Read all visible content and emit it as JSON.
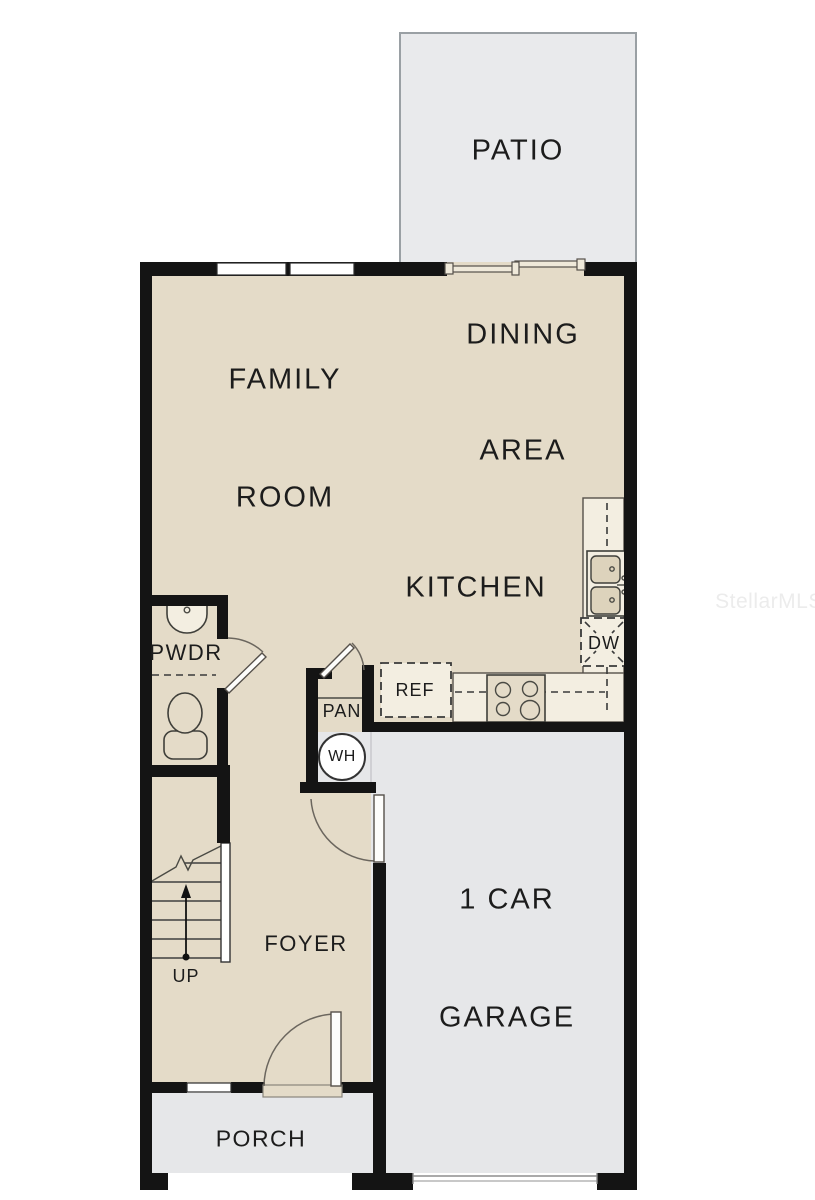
{
  "colors": {
    "floor_beige": "#e4dbc8",
    "concrete_gray": "#e6e7e9",
    "patio_gray": "#e9eaec",
    "wall_black": "#141414",
    "counter_cream": "#f3eee1",
    "fixture_tan": "#ddd3bc",
    "line_dark": "#3a3a3a",
    "label_text": "#1c1c1c",
    "watermark_gray": "#ececec"
  },
  "rooms": {
    "patio": {
      "label": "PATIO"
    },
    "family_room": {
      "line1": "FAMILY",
      "line2": "ROOM"
    },
    "dining_area": {
      "line1": "DINING",
      "line2": "AREA"
    },
    "kitchen": {
      "label": "KITCHEN"
    },
    "powder_room": {
      "label": "PWDR"
    },
    "pantry": {
      "label": "PAN"
    },
    "foyer": {
      "label": "FOYER"
    },
    "garage": {
      "line1": "1 CAR",
      "line2": "GARAGE"
    },
    "porch": {
      "label": "PORCH"
    }
  },
  "fixtures": {
    "water_heater": {
      "label": "WH"
    },
    "refrigerator": {
      "label": "REF"
    },
    "dishwasher": {
      "label": "DW"
    }
  },
  "stairs": {
    "direction_label": "UP"
  },
  "watermark": {
    "text": "StellarMLS"
  }
}
